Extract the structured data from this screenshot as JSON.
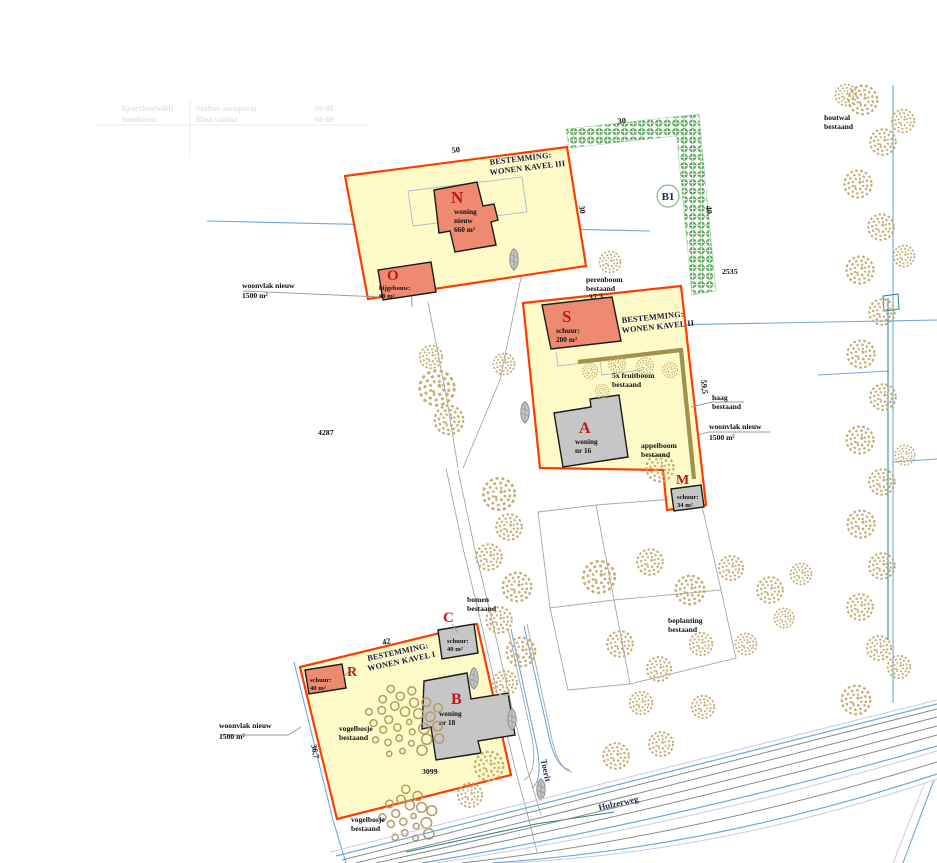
{
  "colors": {
    "parcel_fill": "#fefbc9",
    "parcel_border": "#ff3c00",
    "building_new": "#ee8a72",
    "building_existing": "#c6c6c6",
    "letter_red": "#c11616",
    "tree_tan": "#c4ad73",
    "hedge_green": "#57a457",
    "haag_olive": "#a3904e",
    "water_blue": "#6fa8dc",
    "teal": "#2e7e8c",
    "navy_text": "#17173f",
    "road_purple": "#cfc8ea",
    "parcel_line_gray": "#a6a6a6"
  },
  "faint_table": {
    "r1c1": "lijsterbes(wild)",
    "r1c2": "Sorbus aucuparia",
    "r1c3": "60-80",
    "r2c1": "hondsroos",
    "r2c2": "Rosa canina",
    "r2c3": "60-80"
  },
  "kavel3": {
    "title1": "BESTEMMING:",
    "title2": "WONEN KAVEL III",
    "dim_top": "50",
    "dim_right": "30"
  },
  "kavel2": {
    "title1": "BESTEMMING:",
    "title2": "WONEN KAVEL II",
    "dim_top": "37,3",
    "dim_right": "59,5"
  },
  "kavel1": {
    "title1": "BESTEMMING:",
    "title2": "WONEN KAVEL I",
    "dim_top": "42",
    "dim_left": "36,7"
  },
  "buildings": {
    "n": {
      "letter": "N",
      "l1": "woning",
      "l2": "nieuw",
      "l3": "660 m²"
    },
    "o": {
      "letter": "O",
      "l1": "bijgebouw:",
      "l2": "80 m²"
    },
    "s": {
      "letter": "S",
      "l1": "schuur:",
      "l2": "200 m²"
    },
    "a": {
      "letter": "A",
      "l1": "woning",
      "l2": "nr 16"
    },
    "m": {
      "letter": "M",
      "l1": "schuur:",
      "l2": "34 m²"
    },
    "c": {
      "letter": "C",
      "l1": "schuur:",
      "l2": "40 m²"
    },
    "r": {
      "letter": "R",
      "l1": "schuur:",
      "l2": "40 m²"
    },
    "b": {
      "letter": "B",
      "l1": "woning",
      "l2": "nr 18"
    }
  },
  "hedge": {
    "dim_top": "30",
    "dim_right": "40",
    "b1": "B1",
    "parcel_no": "2535"
  },
  "annotations": {
    "woonvlak_nw": {
      "l1": "woonvlak nieuw",
      "l2": "1500 m²"
    },
    "woonvlak_e": {
      "l1": "woonvlak nieuw",
      "l2": "1500 m²"
    },
    "woonvlak_sw": {
      "l1": "woonvlak nieuw",
      "l2": "1500 m²"
    },
    "houtwal": {
      "l1": "houtwal",
      "l2": "bestaand"
    },
    "perenboom": {
      "l1": "perenboom",
      "l2": "bestaand"
    },
    "fruitboom": {
      "l1": "5x fruitboom",
      "l2": "bestaand"
    },
    "haag": {
      "l1": "haag",
      "l2": "bestaand"
    },
    "appelboom": {
      "l1": "appelboom",
      "l2": "bestaand"
    },
    "bomen": {
      "l1": "bomen",
      "l2": "bestaand"
    },
    "beplanting": {
      "l1": "beplanting",
      "l2": "bestaand"
    },
    "vogelbosje_n": {
      "l1": "vogelbosje",
      "l2": "bestaand"
    },
    "vogelbosje_s": {
      "l1": "vogelbosje",
      "l2": "bestaand"
    },
    "parcel_4287": "4287",
    "parcel_3099": "3099"
  },
  "roads": {
    "toerit": "Toerit",
    "hulzerweg": "Hulzerweg"
  },
  "map": {
    "trees": [
      [
        437,
        388,
        1.15
      ],
      [
        449,
        420,
        0.95
      ],
      [
        431,
        357,
        0.75
      ],
      [
        504,
        364,
        0.7
      ],
      [
        610,
        262,
        0.7
      ],
      [
        590,
        371,
        0.5
      ],
      [
        617,
        364,
        0.55
      ],
      [
        645,
        366,
        0.55
      ],
      [
        670,
        370,
        0.5
      ],
      [
        602,
        391,
        0.45
      ],
      [
        660,
        468,
        0.9
      ],
      [
        499,
        494,
        1.05
      ],
      [
        509,
        527,
        0.85
      ],
      [
        489,
        557,
        0.85
      ],
      [
        517,
        587,
        0.95
      ],
      [
        499,
        620,
        0.85
      ],
      [
        521,
        652,
        0.95
      ],
      [
        505,
        683,
        0.8
      ],
      [
        489,
        766,
        0.95
      ],
      [
        470,
        795,
        0.8
      ],
      [
        599,
        577,
        1.05
      ],
      [
        650,
        562,
        0.85
      ],
      [
        690,
        590,
        0.95
      ],
      [
        731,
        568,
        0.8
      ],
      [
        770,
        590,
        0.85
      ],
      [
        801,
        574,
        0.7
      ],
      [
        620,
        644,
        0.85
      ],
      [
        659,
        669,
        0.8
      ],
      [
        701,
        644,
        0.75
      ],
      [
        641,
        703,
        0.75
      ],
      [
        616,
        756,
        0.85
      ],
      [
        661,
        744,
        0.8
      ],
      [
        703,
        707,
        0.75
      ],
      [
        746,
        644,
        0.7
      ],
      [
        784,
        618,
        0.65
      ],
      [
        856,
        700,
        0.95
      ],
      [
        899,
        667,
        0.75
      ],
      [
        863,
        100,
        0.95
      ],
      [
        883,
        142,
        0.85
      ],
      [
        858,
        184,
        0.9
      ],
      [
        881,
        227,
        0.85
      ],
      [
        860,
        270,
        0.9
      ],
      [
        882,
        312,
        0.85
      ],
      [
        861,
        354,
        0.9
      ],
      [
        883,
        397,
        0.85
      ],
      [
        860,
        440,
        0.9
      ],
      [
        882,
        482,
        0.85
      ],
      [
        861,
        524,
        0.9
      ],
      [
        882,
        566,
        0.85
      ],
      [
        860,
        607,
        0.85
      ],
      [
        879,
        648,
        0.8
      ],
      [
        903,
        121,
        0.75
      ],
      [
        846,
        95,
        0.7
      ],
      [
        904,
        256,
        0.7
      ],
      [
        905,
        455,
        0.65
      ]
    ],
    "leaves": [
      [
        514,
        259
      ],
      [
        474,
        678
      ],
      [
        512,
        719
      ],
      [
        541,
        789
      ],
      [
        525,
        412
      ]
    ],
    "bosjes": [
      {
        "cx": 404,
        "cy": 722,
        "rx": 40,
        "ry": 36,
        "n": 30
      },
      {
        "cx": 409,
        "cy": 816,
        "rx": 27,
        "ry": 29,
        "n": 18
      }
    ]
  }
}
